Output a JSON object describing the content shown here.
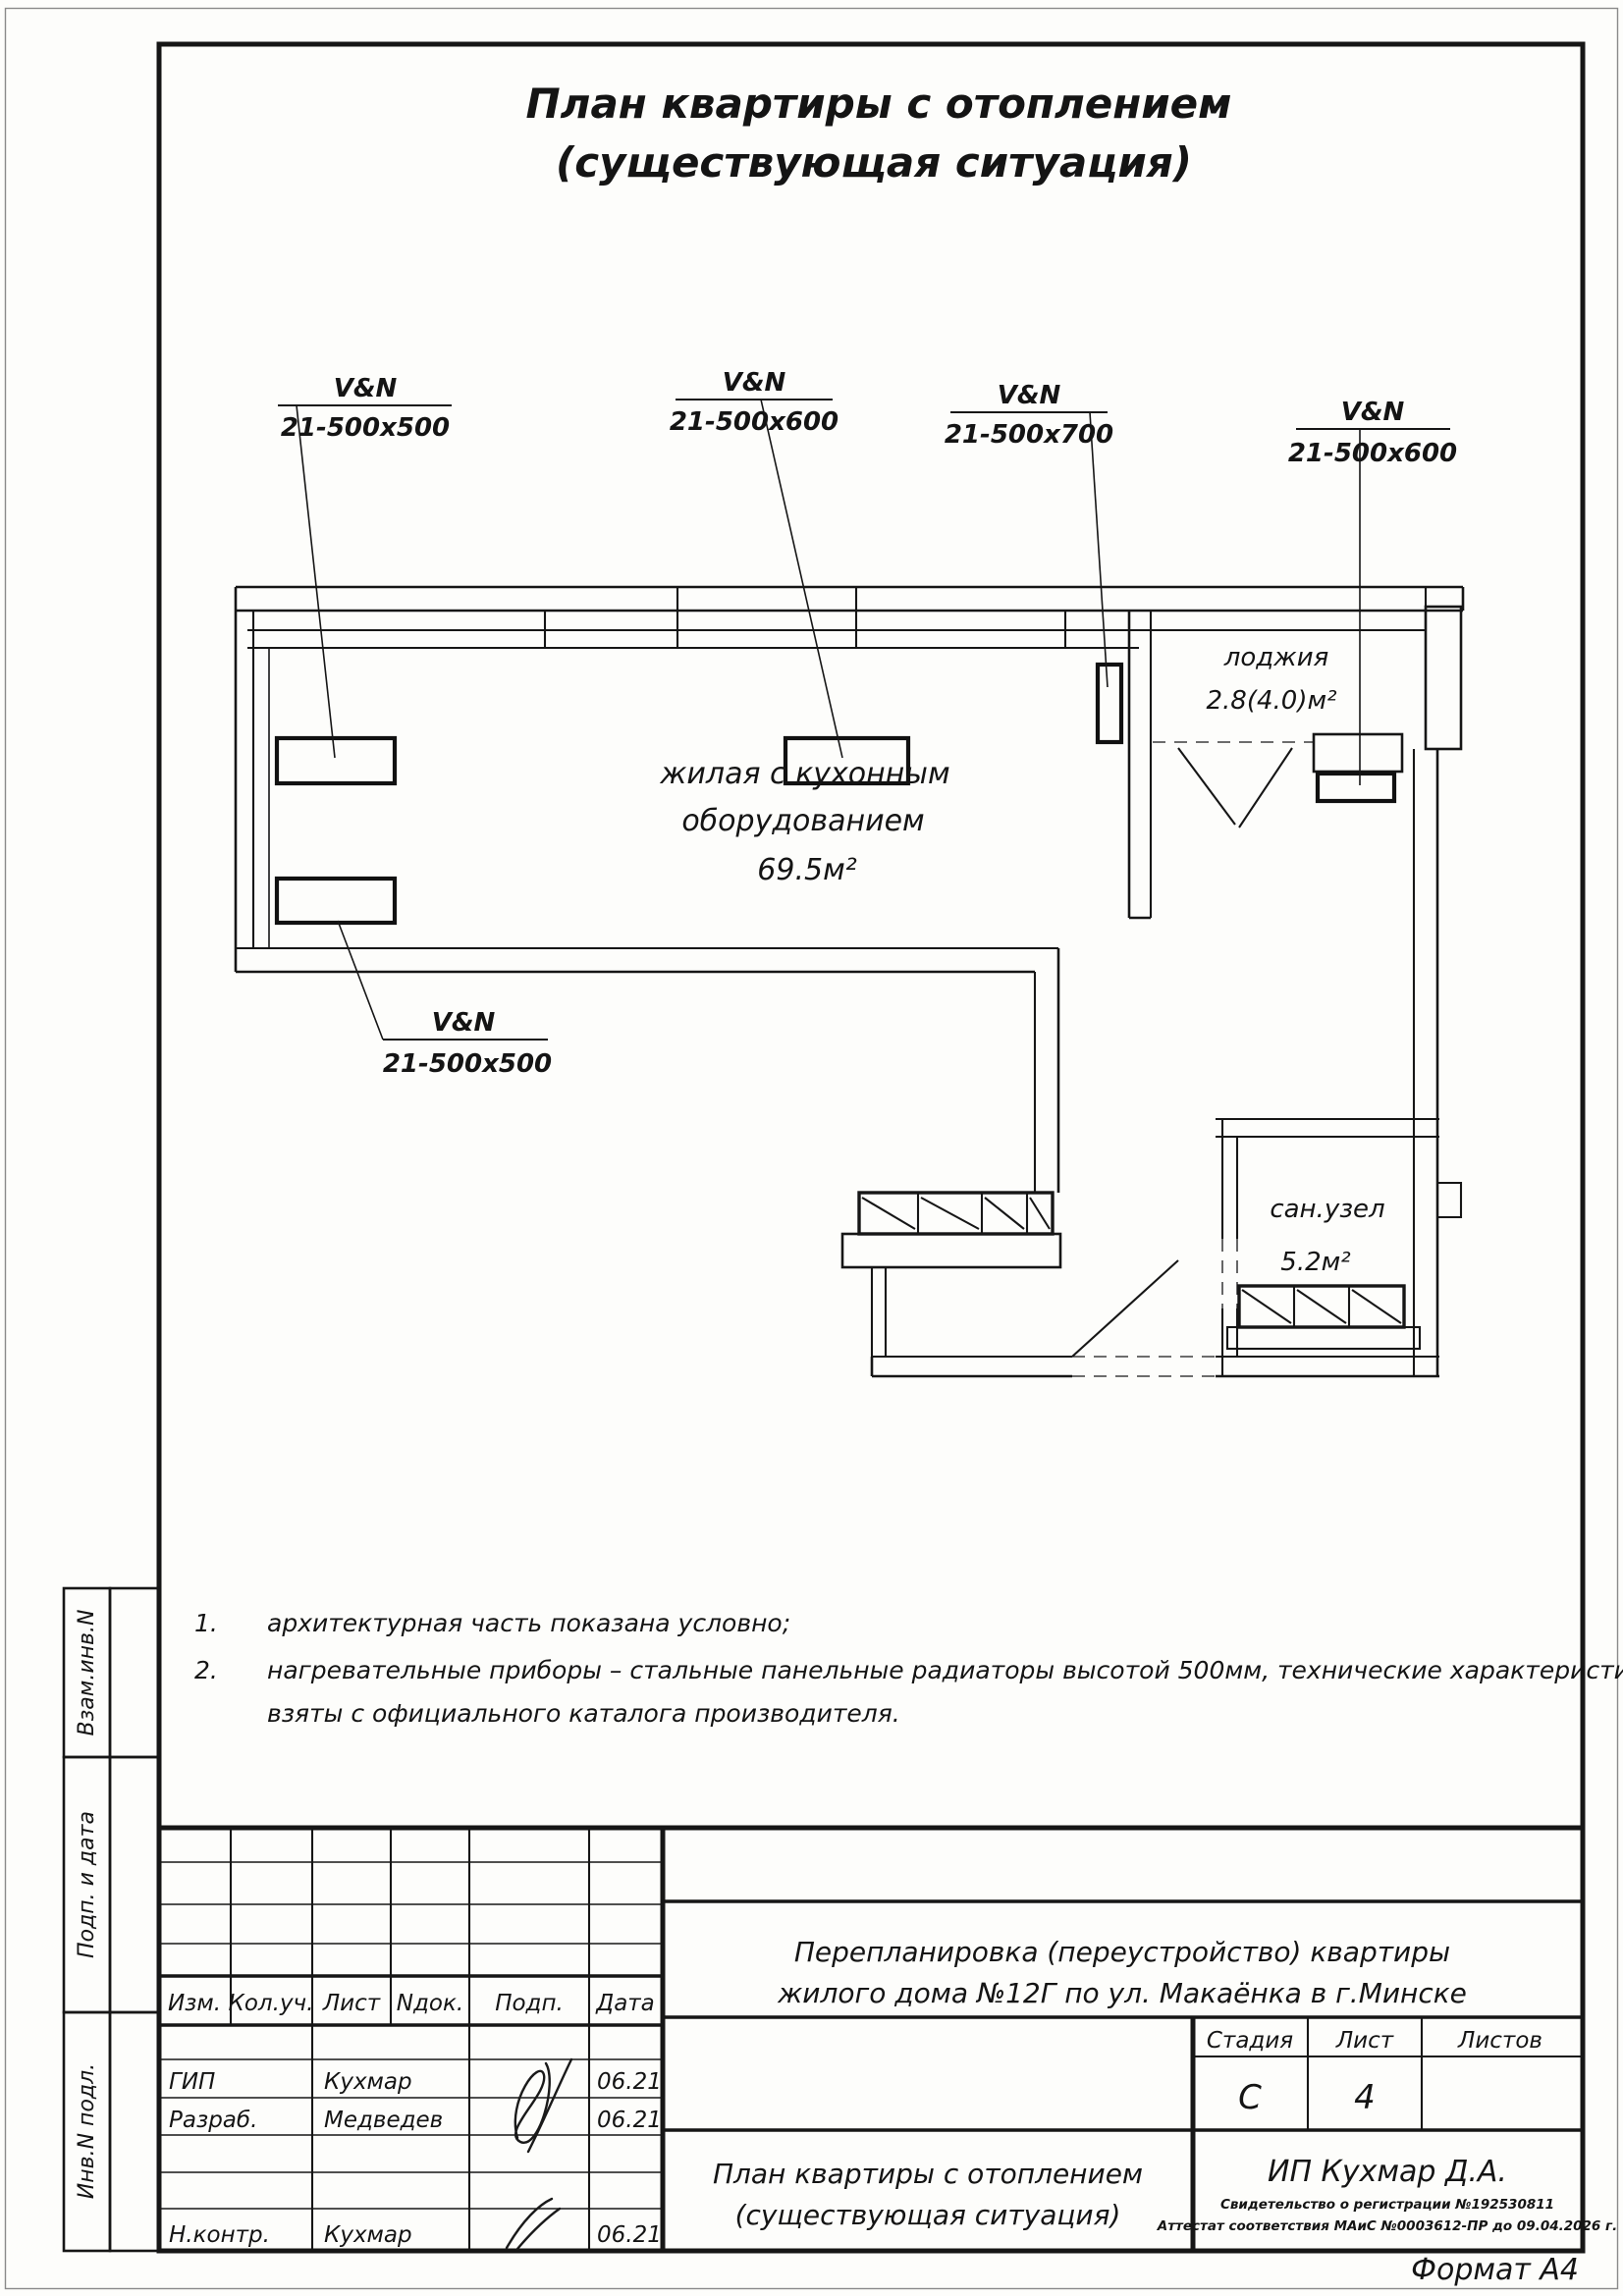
{
  "sheet": {
    "title_line1": "План квартиры с отоплением",
    "title_line2": "(существующая ситуация)",
    "format_label": "Формат А4"
  },
  "plan": {
    "rooms": {
      "living": {
        "name_line1": "жилая с кухонным",
        "name_line2": "оборудованием",
        "area": "69.5м²"
      },
      "loggia": {
        "name": "лоджия",
        "area": "2.8(4.0)м²"
      },
      "bathroom": {
        "name": "сан.узел",
        "area": "5.2м²"
      }
    },
    "radiator_labels": [
      {
        "model": "V&N",
        "size": "21-500x500"
      },
      {
        "model": "V&N",
        "size": "21-500x600"
      },
      {
        "model": "V&N",
        "size": "21-500x700"
      },
      {
        "model": "V&N",
        "size": "21-500x600"
      },
      {
        "model": "V&N",
        "size": "21-500x500"
      }
    ]
  },
  "notes": {
    "n1_num": "1.",
    "n1_text": "архитектурная часть показана условно;",
    "n2_num": "2.",
    "n2_line1": "нагревательные приборы – стальные панельные радиаторы высотой 500мм, технические характеристики",
    "n2_line2": "взяты с официального каталога производителя."
  },
  "sidebar": {
    "labels": [
      "Взам.инв.N",
      "Подп. и дата",
      "Инв.N подл."
    ]
  },
  "titleblock": {
    "headers": [
      "Изм.",
      "Кол.уч.",
      "Лист",
      "Nдок.",
      "Подп.",
      "Дата"
    ],
    "rows": [
      {
        "role": "ГИП",
        "name": "Кухмар",
        "date": "06.21"
      },
      {
        "role": "Разраб.",
        "name": "Медведев",
        "date": "06.21"
      },
      {
        "role": "Н.контр.",
        "name": "Кухмар",
        "date": "06.21"
      }
    ],
    "project_line1": "Перепланировка (переустройство) квартиры",
    "project_line2": "жилого дома №12Г по ул. Макаёнка в г.Минске",
    "doc_title_line1": "План квартиры с отоплением",
    "doc_title_line2": "(существующая ситуация)",
    "stage_header": "Стадия",
    "sheet_header": "Лист",
    "sheets_header": "Листов",
    "stage_value": "С",
    "sheet_value": "4",
    "sheets_value": "",
    "org": "ИП Кухмар Д.А.",
    "cert_line1": "Свидетельство о регистрации №192530811",
    "cert_line2": "Аттестат соответствия МАиС №0003612-ПР до 09.04.2026 г."
  }
}
